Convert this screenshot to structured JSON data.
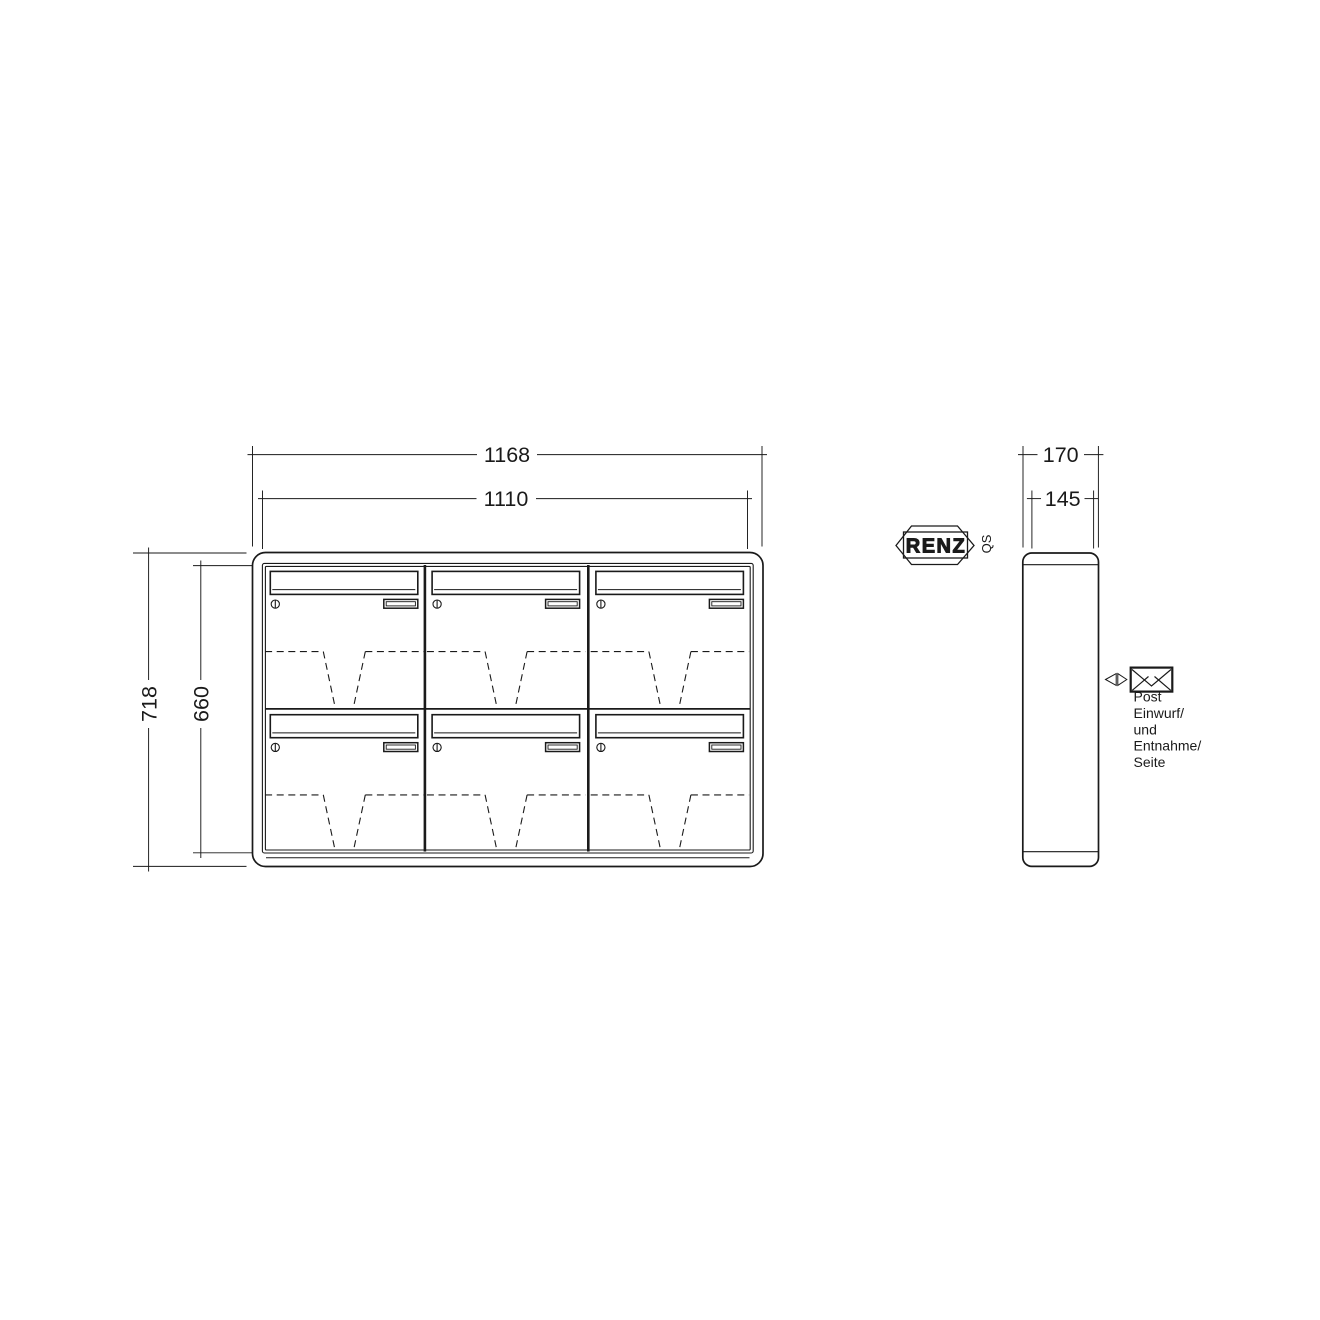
{
  "front_view": {
    "dims": {
      "width_outer": "1168",
      "width_inner": "1110",
      "height_outer": "718",
      "height_inner": "660"
    }
  },
  "side_view": {
    "dims": {
      "depth_outer": "170",
      "depth_inner": "145"
    }
  },
  "branding": {
    "logo": "RENZ",
    "qs": "QS"
  },
  "note": {
    "lines": [
      "Post",
      "Einwurf/",
      "und",
      "Entnahme/",
      "Seite"
    ]
  },
  "colors": {
    "line": "#1a1a1a",
    "background": "#ffffff"
  }
}
